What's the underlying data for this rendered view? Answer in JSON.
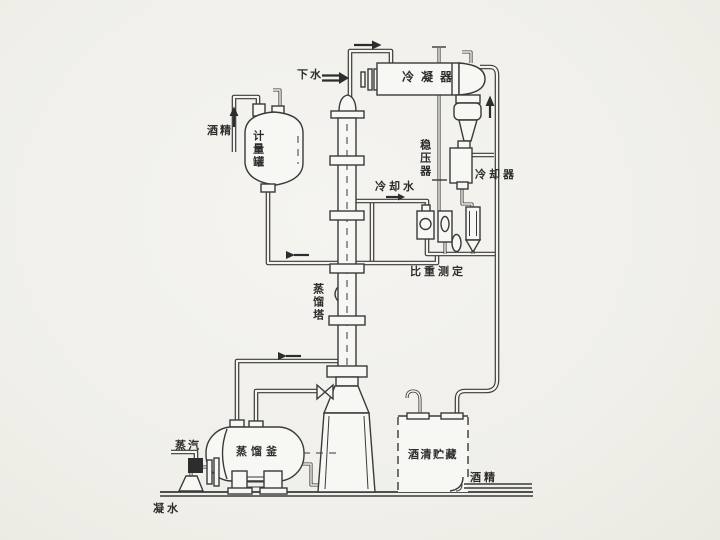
{
  "diagram": {
    "labels": {
      "down_water": "下水",
      "condenser": "冷凝器",
      "alcohol_in": "酒精",
      "measuring_tank": "计量罐",
      "stabilizer": "稳压器",
      "cooling_water": "冷却水",
      "cooler": "冷却器",
      "gravity_test": "比重测定",
      "tower": "蒸馏塔",
      "kettle": "蒸馏釜",
      "steam": "蒸汽",
      "storage": "酒清贮藏",
      "alcohol_out": "酒精",
      "condensate": "凝水"
    },
    "colors": {
      "line": "#3a3a3a",
      "ink": "#2d2d2d",
      "paper": "#f1f0ec",
      "vessel_fill": "#f7f7f3",
      "pipe_inner": "#f5f4ef"
    }
  }
}
